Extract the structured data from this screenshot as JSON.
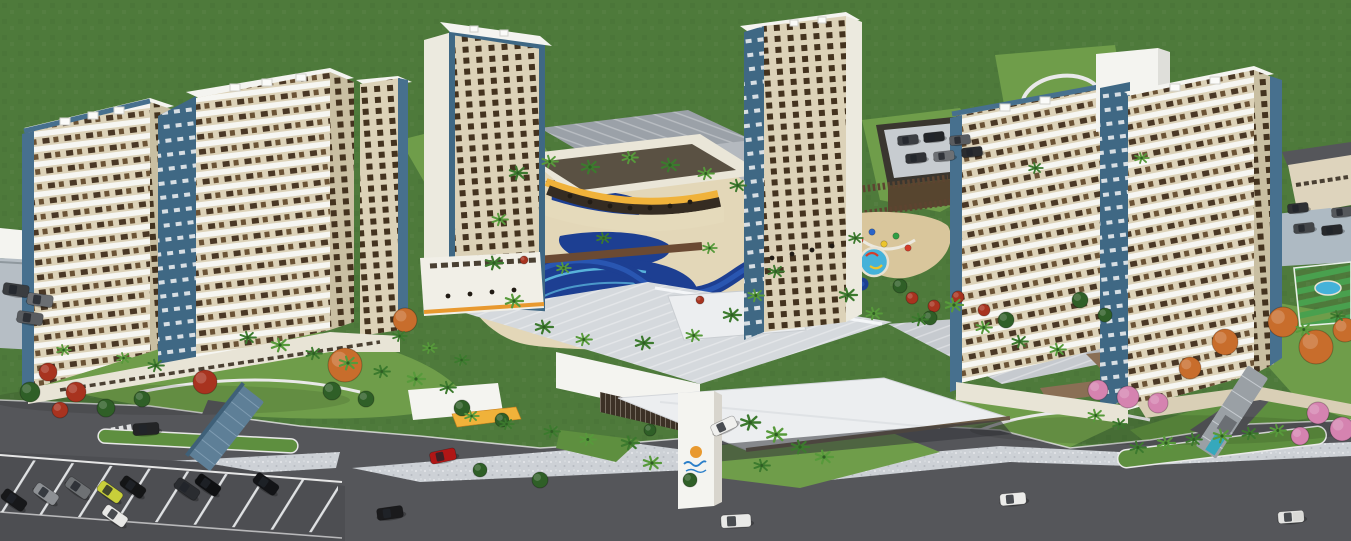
{
  "meta": {
    "width": 1351,
    "height": 541,
    "kind": "3d-architectural-aerial-render"
  },
  "scene_description": "Aerial 3D rendering of a resort condominium: five beige towers with white balconies and blue trim, central water-park pools, clubhouse, large gray convention-center roofs, entrance pylon with sun logo, gates, roads, parking lots, palms and flowering trees on green grounds",
  "logo": {
    "icon": "sun-logo",
    "sun_color": "#f3a51f",
    "script_color": "#2b7fc9",
    "text": ""
  },
  "palette": {
    "grass": "#4e7a3b",
    "lawn": "#6f9d4a",
    "lawn2": "#5e8f3f",
    "road": "#55565a",
    "roadDark": "#4d4e52",
    "sidewalk": "#cdd1d6",
    "deck": "#e3d7b8",
    "sand": "#d9c69c",
    "towerBeige": "#dcd2b8",
    "towerBeigeDark": "#c9bfa2",
    "white": "#f4f4f0",
    "blueTrim": "#47708e",
    "blueCore": "#3f6884",
    "windowDark": "#4a3826",
    "poolDeep": "#1d3f92",
    "poolMid": "#2f63c1",
    "poolLight": "#45b2d9",
    "orange": "#e8992f",
    "yellow": "#f0b23a",
    "roofGray": "#9ba1a8",
    "roofLight": "#d5d9dd",
    "roofPale": "#eceef0",
    "brown": "#8a6f55",
    "woodDark": "#5d4430",
    "boardwalk": "#6b4a33",
    "canopyBlue": "#5e7f97",
    "canopyGray": "#9aa0a5",
    "wallBeige": "#d9cfb6",
    "courtGreen": "#3e8e41",
    "palm": "#3c7a2e",
    "palmLight": "#579a3b"
  },
  "palms": [
    [
      516,
      178,
      1,
      0
    ],
    [
      548,
      166,
      0.9,
      1
    ],
    [
      588,
      172,
      1,
      0
    ],
    [
      628,
      162,
      0.9,
      1
    ],
    [
      668,
      170,
      1,
      0
    ],
    [
      704,
      178,
      0.9,
      1
    ],
    [
      736,
      190,
      0.9,
      0
    ],
    [
      498,
      224,
      0.9,
      1
    ],
    [
      492,
      268,
      1,
      0
    ],
    [
      512,
      306,
      1,
      1
    ],
    [
      542,
      332,
      1,
      0
    ],
    [
      582,
      344,
      0.9,
      1
    ],
    [
      642,
      348,
      1,
      0
    ],
    [
      692,
      340,
      0.9,
      1
    ],
    [
      730,
      320,
      1,
      0
    ],
    [
      754,
      300,
      0.9,
      1
    ],
    [
      774,
      276,
      0.9,
      0
    ],
    [
      708,
      252,
      0.8,
      1
    ],
    [
      602,
      242,
      0.8,
      0
    ],
    [
      562,
      272,
      0.8,
      1
    ],
    [
      846,
      300,
      1,
      0
    ],
    [
      872,
      318,
      0.9,
      1
    ],
    [
      918,
      324,
      0.9,
      0
    ],
    [
      952,
      310,
      1,
      1
    ],
    [
      854,
      242,
      0.8,
      0
    ],
    [
      982,
      332,
      0.9,
      1
    ],
    [
      1018,
      346,
      0.9,
      0
    ],
    [
      1056,
      354,
      0.9,
      1
    ],
    [
      246,
      342,
      0.9,
      0
    ],
    [
      278,
      350,
      1,
      1
    ],
    [
      312,
      358,
      0.9,
      0
    ],
    [
      346,
      368,
      1,
      1
    ],
    [
      380,
      376,
      0.9,
      0
    ],
    [
      414,
      384,
      1,
      1
    ],
    [
      446,
      392,
      0.9,
      0
    ],
    [
      122,
      362,
      0.8,
      1
    ],
    [
      154,
      370,
      0.9,
      0
    ],
    [
      62,
      354,
      0.8,
      1
    ],
    [
      628,
      448,
      1,
      0
    ],
    [
      650,
      468,
      1,
      1
    ],
    [
      748,
      428,
      1.1,
      0
    ],
    [
      774,
      440,
      1.1,
      1
    ],
    [
      798,
      452,
      1,
      0
    ],
    [
      822,
      462,
      1,
      1
    ],
    [
      760,
      470,
      0.9,
      0
    ],
    [
      586,
      444,
      0.9,
      1
    ],
    [
      550,
      436,
      0.9,
      0
    ],
    [
      1136,
      452,
      0.9,
      0
    ],
    [
      1164,
      448,
      1,
      1
    ],
    [
      1192,
      444,
      0.9,
      0
    ],
    [
      1220,
      441,
      1,
      1
    ],
    [
      1248,
      438,
      0.9,
      0
    ],
    [
      1276,
      435,
      0.9,
      1
    ],
    [
      1094,
      420,
      0.9,
      1
    ],
    [
      1118,
      428,
      0.8,
      0
    ],
    [
      1302,
      334,
      0.9,
      1
    ],
    [
      1336,
      320,
      0.8,
      0
    ],
    [
      1140,
      162,
      0.8,
      1
    ],
    [
      1034,
      172,
      0.8,
      0
    ],
    [
      398,
      340,
      0.8,
      0
    ],
    [
      428,
      352,
      0.8,
      1
    ],
    [
      460,
      364,
      0.8,
      0
    ],
    [
      470,
      420,
      0.8,
      1
    ],
    [
      505,
      428,
      0.8,
      0
    ]
  ],
  "trees": [
    {
      "type": "autumn-orange",
      "color": "#c86d2c",
      "items": [
        [
          345,
          365,
          17
        ],
        [
          405,
          320,
          12
        ],
        [
          1225,
          342,
          13
        ],
        [
          1283,
          322,
          15
        ],
        [
          1316,
          347,
          17
        ],
        [
          1345,
          330,
          12
        ],
        [
          1190,
          368,
          11
        ]
      ]
    },
    {
      "type": "red-flower-bush",
      "color": "#a8331f",
      "items": [
        [
          205,
          382,
          12
        ],
        [
          48,
          372,
          9
        ],
        [
          76,
          392,
          10
        ],
        [
          60,
          410,
          8
        ],
        [
          912,
          298,
          6
        ],
        [
          934,
          306,
          6
        ],
        [
          958,
          297,
          6
        ],
        [
          984,
          310,
          6
        ],
        [
          524,
          260,
          4
        ],
        [
          700,
          300,
          4
        ]
      ]
    },
    {
      "type": "pink-flower-bush",
      "color": "#d583b0",
      "items": [
        [
          1098,
          390,
          10
        ],
        [
          1128,
          397,
          11
        ],
        [
          1158,
          403,
          10
        ],
        [
          1318,
          413,
          11
        ],
        [
          1342,
          429,
          12
        ],
        [
          1300,
          436,
          9
        ]
      ]
    },
    {
      "type": "green-bush",
      "color": "#2f5f27",
      "items": [
        [
          30,
          392,
          10
        ],
        [
          106,
          408,
          9
        ],
        [
          142,
          399,
          8
        ],
        [
          462,
          408,
          8
        ],
        [
          502,
          420,
          7
        ],
        [
          332,
          391,
          9
        ],
        [
          366,
          399,
          8
        ],
        [
          900,
          286,
          7
        ],
        [
          930,
          318,
          7
        ],
        [
          1006,
          320,
          8
        ],
        [
          650,
          430,
          6
        ],
        [
          690,
          480,
          7
        ],
        [
          540,
          480,
          8
        ],
        [
          480,
          470,
          7
        ],
        [
          1080,
          300,
          8
        ],
        [
          1105,
          315,
          7
        ]
      ]
    }
  ],
  "cars": [
    {
      "x": 443,
      "y": 456,
      "a": -12,
      "c": "#b01616",
      "kind": "car"
    },
    {
      "x": 390,
      "y": 513,
      "a": -8,
      "c": "#1a1a1c",
      "kind": "car"
    },
    {
      "x": 146,
      "y": 429,
      "a": -4,
      "c": "#232426",
      "kind": "car"
    },
    {
      "x": 736,
      "y": 521,
      "a": -3,
      "c": "#e9e9e7",
      "kind": "van"
    },
    {
      "x": 724,
      "y": 426,
      "a": -25,
      "c": "#f0f0ee",
      "kind": "car"
    },
    {
      "x": 1013,
      "y": 499,
      "a": -5,
      "c": "#ececea",
      "kind": "car"
    },
    {
      "x": 1291,
      "y": 517,
      "a": -4,
      "c": "#e4e4e2",
      "kind": "pickup"
    },
    {
      "x": 14,
      "y": 500,
      "a": 35,
      "c": "#17181a",
      "kind": "car"
    },
    {
      "x": 46,
      "y": 494,
      "a": 35,
      "c": "#8d9094",
      "kind": "car"
    },
    {
      "x": 78,
      "y": 488,
      "a": 35,
      "c": "#6e7174",
      "kind": "car"
    },
    {
      "x": 110,
      "y": 492,
      "a": 35,
      "c": "#c8cf3a",
      "kind": "car"
    },
    {
      "x": 133,
      "y": 487,
      "a": 35,
      "c": "#141516",
      "kind": "car"
    },
    {
      "x": 115,
      "y": 516,
      "a": 35,
      "c": "#e8e8e6",
      "kind": "car"
    },
    {
      "x": 187,
      "y": 489,
      "a": 35,
      "c": "#2a2c30",
      "kind": "car"
    },
    {
      "x": 208,
      "y": 485,
      "a": 35,
      "c": "#0f1012",
      "kind": "car"
    },
    {
      "x": 266,
      "y": 484,
      "a": 35,
      "c": "#131417",
      "kind": "car"
    },
    {
      "x": 16,
      "y": 290,
      "a": 8,
      "c": "#3a3d40",
      "kind": "car"
    },
    {
      "x": 40,
      "y": 300,
      "a": 8,
      "c": "#6b6e72",
      "kind": "car"
    },
    {
      "x": 30,
      "y": 318,
      "a": 8,
      "c": "#595c60",
      "kind": "car"
    },
    {
      "x": 908,
      "y": 140,
      "a": -6,
      "c": "#3c3f43",
      "kind": "car",
      "s": 0.8
    },
    {
      "x": 934,
      "y": 137,
      "a": -6,
      "c": "#232528",
      "kind": "car",
      "s": 0.8
    },
    {
      "x": 960,
      "y": 140,
      "a": -6,
      "c": "#595c60",
      "kind": "car",
      "s": 0.8
    },
    {
      "x": 916,
      "y": 158,
      "a": -6,
      "c": "#303236",
      "kind": "car",
      "s": 0.8
    },
    {
      "x": 944,
      "y": 156,
      "a": -6,
      "c": "#6d7074",
      "kind": "car",
      "s": 0.8
    },
    {
      "x": 972,
      "y": 152,
      "a": -6,
      "c": "#2a2c2f",
      "kind": "car",
      "s": 0.8
    },
    {
      "x": 1298,
      "y": 208,
      "a": -6,
      "c": "#2f3134",
      "kind": "car",
      "s": 0.8
    },
    {
      "x": 1304,
      "y": 228,
      "a": -6,
      "c": "#434649",
      "kind": "car",
      "s": 0.8
    },
    {
      "x": 1332,
      "y": 230,
      "a": -6,
      "c": "#27292c",
      "kind": "car",
      "s": 0.8
    },
    {
      "x": 1342,
      "y": 212,
      "a": -6,
      "c": "#55585c",
      "kind": "car",
      "s": 0.8
    }
  ],
  "playground_dots": [
    [
      860,
      240,
      "#d43c2a"
    ],
    [
      872,
      232,
      "#2a64c9"
    ],
    [
      884,
      244,
      "#ecc52e"
    ],
    [
      896,
      236,
      "#2f9e44"
    ],
    [
      908,
      248,
      "#d43c2a"
    ],
    [
      868,
      256,
      "#7b3fc1"
    ]
  ],
  "terrace_tables": [
    [
      570,
      196
    ],
    [
      590,
      202
    ],
    [
      610,
      206
    ],
    [
      630,
      208
    ],
    [
      650,
      208
    ],
    [
      670,
      206
    ],
    [
      690,
      202
    ],
    [
      448,
      296
    ],
    [
      470,
      294
    ],
    [
      492,
      292
    ],
    [
      514,
      290
    ],
    [
      772,
      258
    ],
    [
      792,
      254
    ],
    [
      812,
      250
    ],
    [
      832,
      246
    ]
  ]
}
